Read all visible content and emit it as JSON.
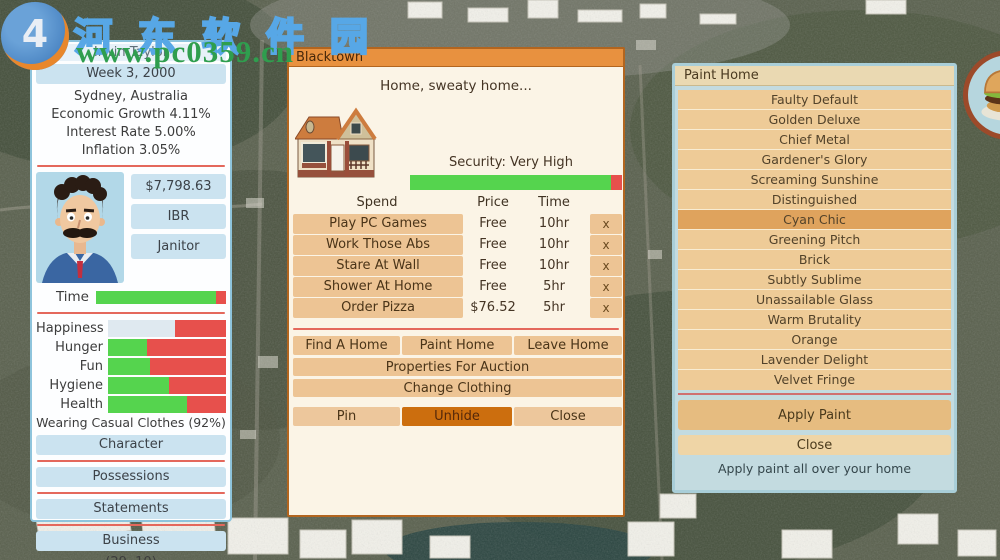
{
  "watermark": {
    "site_name": "河东软件园",
    "site_url": "www.pc0359.cn"
  },
  "colors": {
    "bar_green": "#55d44e",
    "bar_red": "#e7504c",
    "happiness_fill": "#dfe9f0",
    "accent_orange": "#e8913f",
    "selected_paint": "#dfa35d",
    "active_control": "#cc6e0e"
  },
  "player_panel": {
    "name": "Irwin Taylor",
    "date": "Week 3, 2000",
    "city": "Sydney, Australia",
    "economic_growth": "Economic Growth 4.11%",
    "interest_rate": "Interest Rate 5.00%",
    "inflation": "Inflation 3.05%",
    "cash": "$7,798.63",
    "residence": "IBR Apartment",
    "job": "Janitor",
    "time_label": "Time",
    "time_pct": 92,
    "stats": [
      {
        "label": "Happiness",
        "pct": 57,
        "fill": "#dfe9f0"
      },
      {
        "label": "Hunger",
        "pct": 33,
        "fill": "#55d44e"
      },
      {
        "label": "Fun",
        "pct": 36,
        "fill": "#55d44e"
      },
      {
        "label": "Hygiene",
        "pct": 52,
        "fill": "#55d44e"
      },
      {
        "label": "Health",
        "pct": 67,
        "fill": "#55d44e"
      }
    ],
    "clothing": "Wearing Casual Clothes (92%)",
    "menu_buttons": [
      "Character",
      "Possessions",
      "Statements",
      "Business"
    ],
    "coordinates": "(29, 10)"
  },
  "home_window": {
    "title": "Blacktown",
    "greeting": "Home, sweaty home...",
    "security_label": "Security: Very High",
    "security_pct": 95,
    "table": {
      "headers": [
        "Spend",
        "Price",
        "Time"
      ],
      "x_label": "x",
      "rows": [
        {
          "action": "Play PC Games",
          "price": "Free",
          "time": "10hr"
        },
        {
          "action": "Work Those Abs",
          "price": "Free",
          "time": "10hr"
        },
        {
          "action": "Stare At Wall",
          "price": "Free",
          "time": "10hr"
        },
        {
          "action": "Shower At Home",
          "price": "Free",
          "time": "5hr"
        },
        {
          "action": "Order Pizza",
          "price": "$76.52",
          "time": "5hr"
        }
      ]
    },
    "actions": [
      "Find A Home",
      "Paint Home",
      "Leave Home"
    ],
    "wide_actions": [
      "Properties For Auction",
      "Change Clothing"
    ],
    "controls": [
      {
        "label": "Pin"
      },
      {
        "label": "Unhide",
        "active": true
      },
      {
        "label": "Close"
      }
    ]
  },
  "paint_window": {
    "title": "Paint Home",
    "options": [
      {
        "label": "Faulty Default"
      },
      {
        "label": "Golden Deluxe"
      },
      {
        "label": "Chief Metal"
      },
      {
        "label": "Gardener's Glory"
      },
      {
        "label": "Screaming Sunshine"
      },
      {
        "label": "Distinguished"
      },
      {
        "label": "Cyan Chic",
        "selected": true
      },
      {
        "label": "Greening Pitch"
      },
      {
        "label": "Brick"
      },
      {
        "label": "Subtly Sublime"
      },
      {
        "label": "Unassailable Glass"
      },
      {
        "label": "Warm Brutality"
      },
      {
        "label": "Orange"
      },
      {
        "label": "Lavender Delight"
      },
      {
        "label": "Velvet Fringe"
      }
    ],
    "apply_label": "Apply Paint",
    "close_label": "Close",
    "caption": "Apply paint all over your home"
  }
}
